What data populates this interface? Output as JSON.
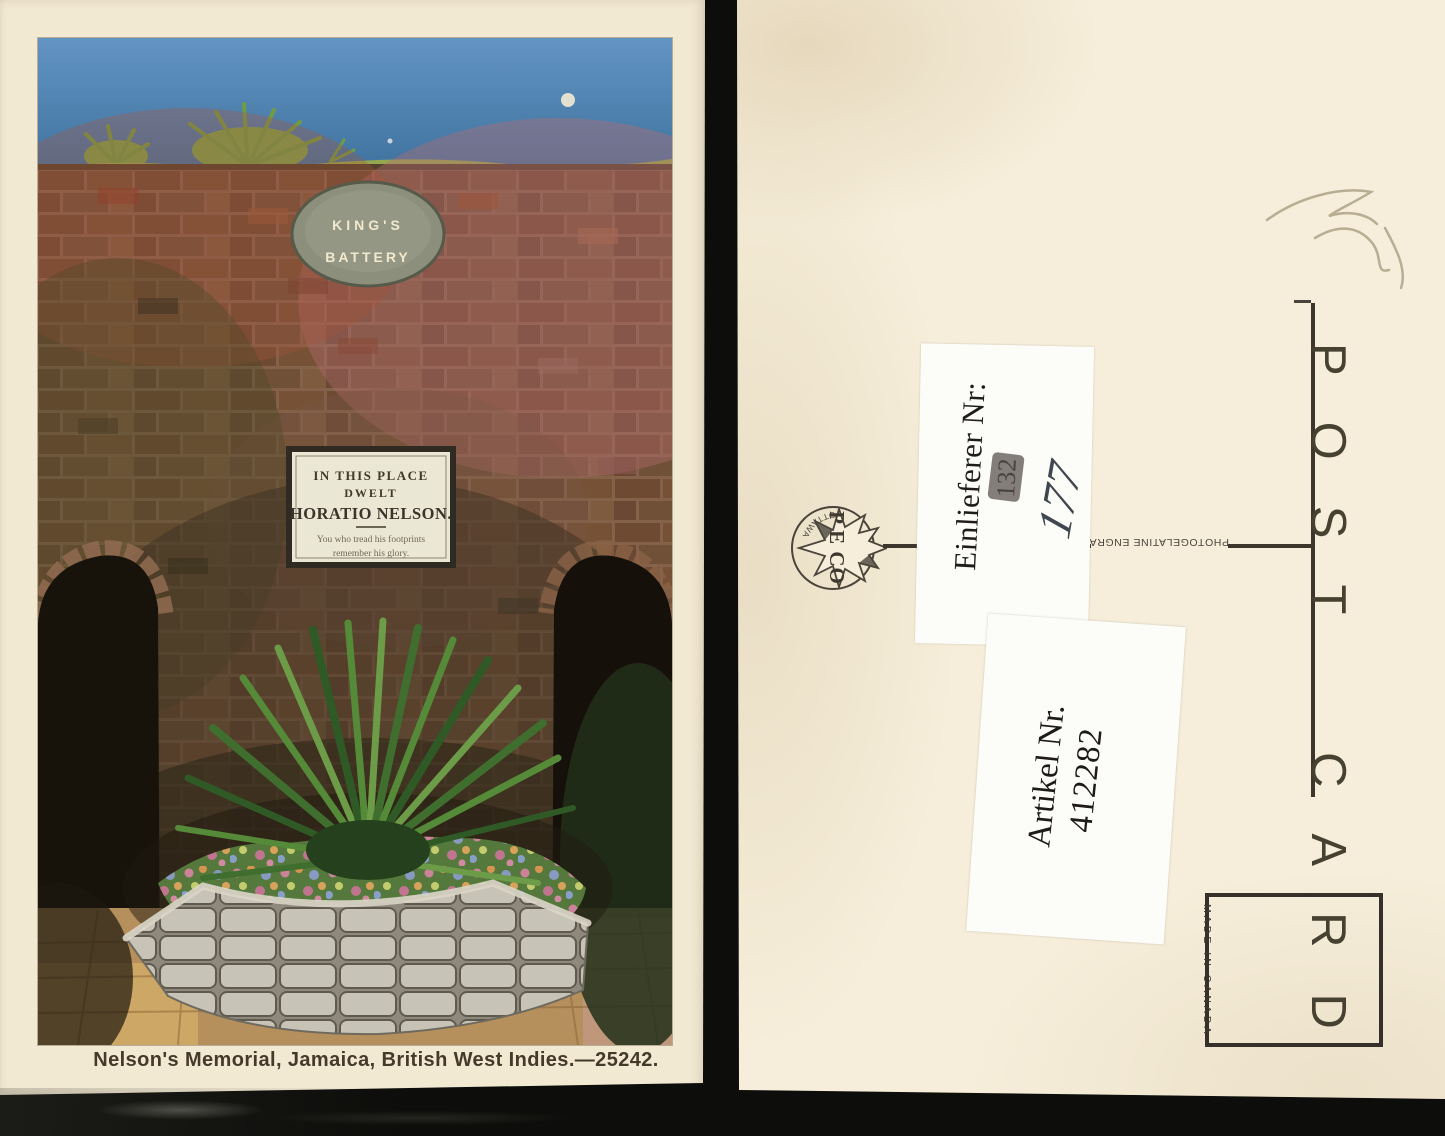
{
  "front": {
    "caption": "Nelson's Memorial, Jamaica, British West Indies.—25242.",
    "oval_sign": {
      "line1": "KING'S",
      "line2": "BATTERY"
    },
    "plaque": {
      "line1": "IN THIS PLACE",
      "line2": "DWELT",
      "line3": "HORATIO NELSON.",
      "line4": "You who tread his footprints",
      "line5": "remember his glory."
    }
  },
  "back": {
    "post_card_word1": "POST",
    "post_card_word2": "CARD",
    "printer_credit": "PHOTOGELATINE ENGRA",
    "stamp_box_text": "MADE IN CANADA",
    "logo": {
      "text": "P E CO",
      "city": "OTTAWA"
    },
    "labels": {
      "einlieferer_title": "Einlieferer Nr:",
      "einlieferer_number": "132",
      "handwritten_number": "177",
      "artikel_title": "Artikel Nr.",
      "artikel_number": "412282"
    }
  },
  "colors": {
    "front_card_cream": "#f2e9d3",
    "back_card_cream": "#f6eeda",
    "ink": "#3c362c",
    "sky_blue": "#5b8cba",
    "brick_brown": "#6e4a33",
    "label_white": "#fcfcf9",
    "background_black": "#0d0d0b"
  }
}
